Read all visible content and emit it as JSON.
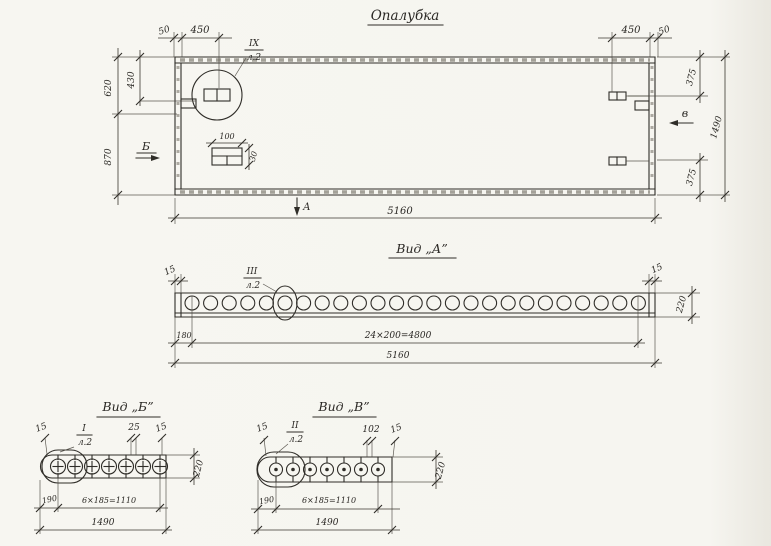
{
  "palette": {
    "paper": "#f6f5f0",
    "ink": "#2f2d28"
  },
  "formwork": {
    "title": "Опалубка",
    "callout_num": "IX",
    "callout_sheet": "л.2",
    "dim_50_left": "50",
    "dim_450_left": "450",
    "dim_450_right": "450",
    "dim_50_right": "50",
    "dim_620": "620",
    "dim_430": "430",
    "dim_870": "870",
    "dim_375_top": "375",
    "dim_1490": "1490",
    "dim_375_bottom": "375",
    "dim_5160": "5160",
    "plate_100": "100",
    "plate_30": "30",
    "marker_b": "Б",
    "marker_v": "в",
    "marker_a": "А"
  },
  "view_a": {
    "title": "Вид „А”",
    "callout_num": "III",
    "callout_sheet": "л.2",
    "dim_15_left": "15",
    "dim_15_right": "15",
    "dim_220": "220",
    "dim_180": "180",
    "dim_holes": "24×200=4800",
    "dim_total": "5160",
    "holes": 25
  },
  "view_b": {
    "title": "Вид „Б”",
    "callout_num": "I",
    "callout_sheet": "л.2",
    "dim_15_left": "15",
    "dim_25": "25",
    "dim_15_right": "15",
    "dim_220": "220",
    "dim_190": "190",
    "dim_holes": "6×185=1110",
    "dim_total": "1490",
    "holes": 7
  },
  "view_v": {
    "title": "Вид „В”",
    "callout_num": "II",
    "callout_sheet": "л.2",
    "dim_15_left": "15",
    "dim_102": "102",
    "dim_15_right": "15",
    "dim_220": "220",
    "dim_190": "190",
    "dim_holes": "6×185=1110",
    "dim_total": "1490",
    "holes": 7
  }
}
